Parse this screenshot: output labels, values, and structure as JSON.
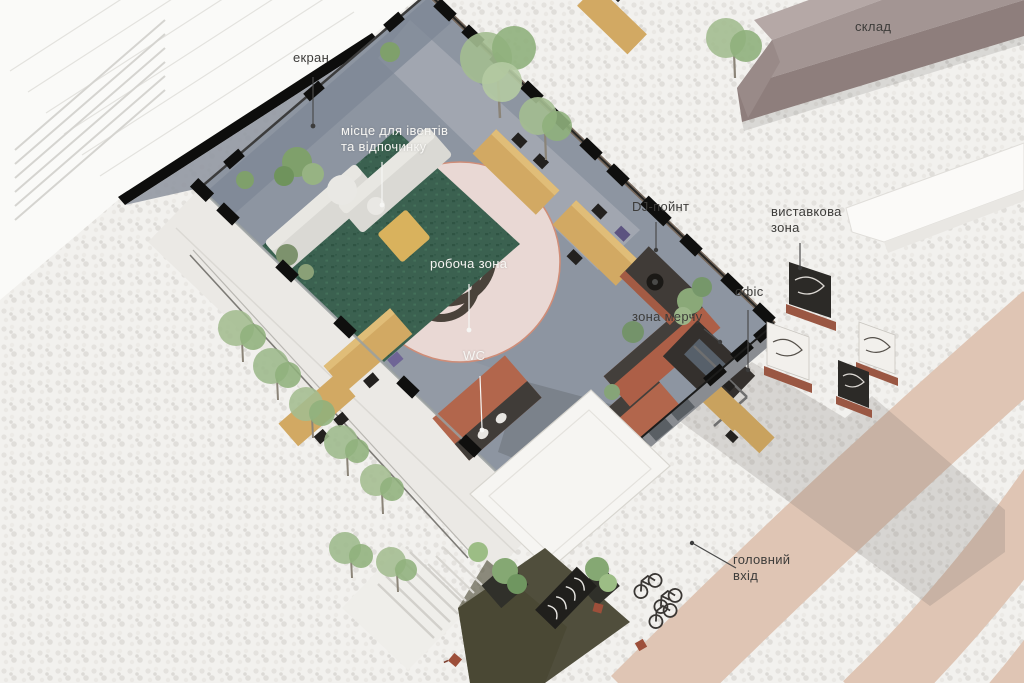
{
  "scene": {
    "type": "axonometric-architectural-plan",
    "labels": {
      "screen": {
        "text": "екран"
      },
      "events_area": {
        "text": "місце для івентів\nта відпочинку"
      },
      "warehouse": {
        "text": "склад"
      },
      "dj_point": {
        "text": "DJ-пойнт"
      },
      "exhibition_zone": {
        "text": "виставкова\nзона"
      },
      "office": {
        "text": "офіс"
      },
      "merch_zone": {
        "text": "зона мерчу"
      },
      "work_zone": {
        "text": "робоча зона"
      },
      "wc": {
        "text": "WC"
      },
      "main_entrance": {
        "text": "головний\nвхід"
      }
    },
    "palette": {
      "plaza": "#f2f1ee",
      "path_pink": "#dfc5b4",
      "floor": "#8d95a1",
      "rug_green": "#3b6150",
      "circle_pink": "#e9d8d4",
      "circle_outline": "#cf8d78",
      "logo_dark": "#49423a",
      "accent_yellow": "#d9b25d",
      "wood": "#d2a963",
      "terracotta": "#b2664c",
      "walls_black": "#0e0e0e",
      "warehouse_roof": "#a39593",
      "white_building": "#fafaf8",
      "platform_olive": "#504e3c",
      "tree_green": "#9cb88b"
    }
  }
}
